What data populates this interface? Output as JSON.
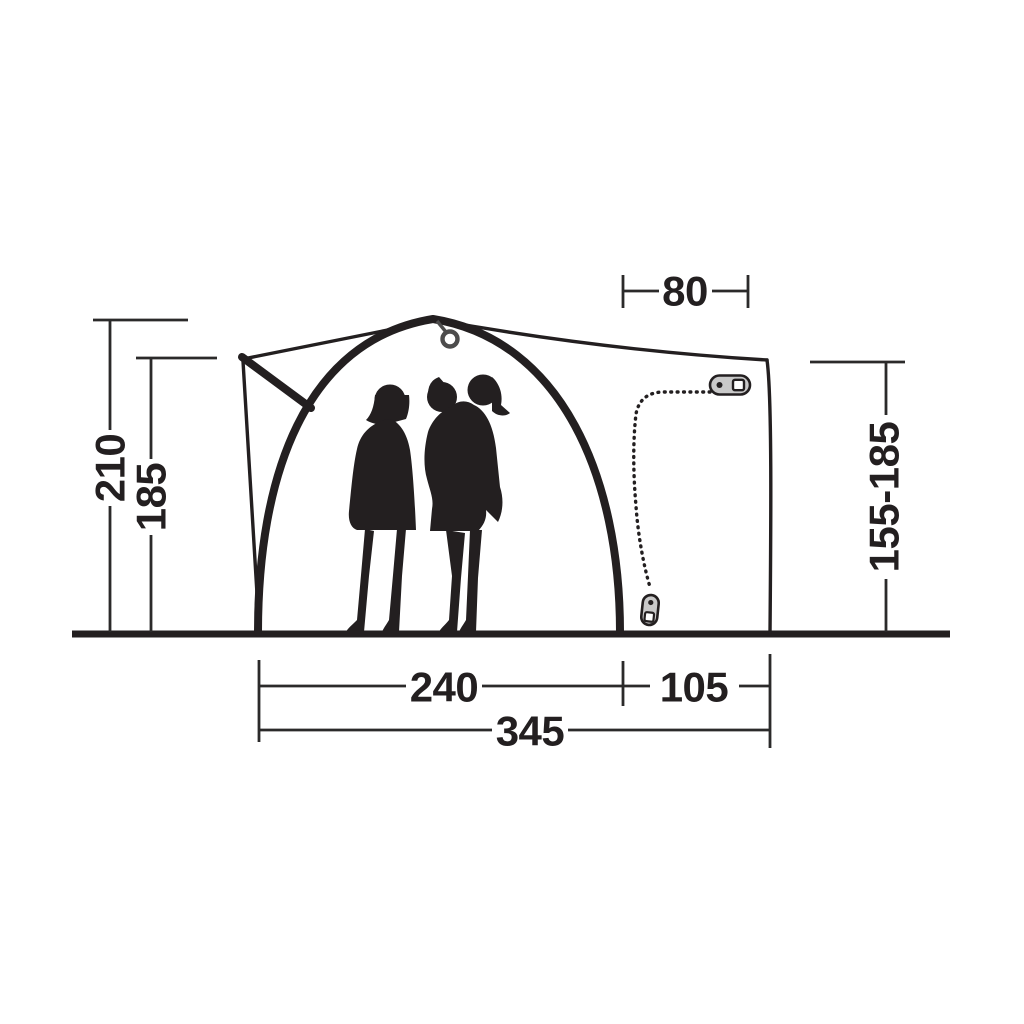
{
  "diagram": {
    "kind": "tent-dimension-drawing",
    "dimensions": {
      "peak_height": "210",
      "canopy_height": "185",
      "rear_top_width": "80",
      "rear_height_range": "155-185",
      "inner_width": "240",
      "rear_depth": "105",
      "total_width": "345"
    },
    "colors": {
      "ink": "#231f20",
      "dimension_line": "#2b2a2a",
      "zipper_pull_fill": "#c9c9c9",
      "background": "#ffffff"
    }
  }
}
